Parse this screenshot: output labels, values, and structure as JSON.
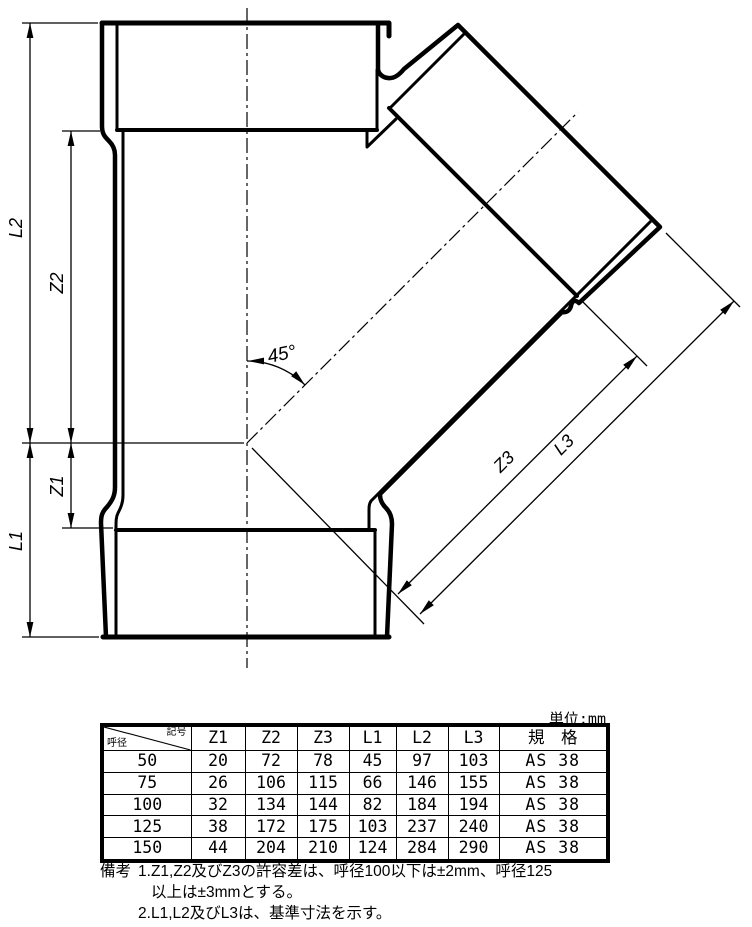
{
  "drawing": {
    "labels": {
      "L2": "L2",
      "Z2": "Z2",
      "Z1": "Z1",
      "L1": "L1",
      "Z3": "Z3",
      "L3": "L3",
      "angle": "45°"
    }
  },
  "table": {
    "unit_label": "単位:mm",
    "corner_top_right": "記号",
    "corner_bottom_left": "呼径",
    "headers": [
      "Z1",
      "Z2",
      "Z3",
      "L1",
      "L2",
      "L3"
    ],
    "standard_header": "規　格",
    "rows": [
      {
        "dia": "50",
        "z1": "20",
        "z2": "72",
        "z3": "78",
        "l1": "45",
        "l2": "97",
        "l3": "103",
        "std": "AS 38"
      },
      {
        "dia": "75",
        "z1": "26",
        "z2": "106",
        "z3": "115",
        "l1": "66",
        "l2": "146",
        "l3": "155",
        "std": "AS 38"
      },
      {
        "dia": "100",
        "z1": "32",
        "z2": "134",
        "z3": "144",
        "l1": "82",
        "l2": "184",
        "l3": "194",
        "std": "AS 38"
      },
      {
        "dia": "125",
        "z1": "38",
        "z2": "172",
        "z3": "175",
        "l1": "103",
        "l2": "237",
        "l3": "240",
        "std": "AS 38"
      },
      {
        "dia": "150",
        "z1": "44",
        "z2": "204",
        "z3": "210",
        "l1": "124",
        "l2": "284",
        "l3": "290",
        "std": "AS 38"
      }
    ]
  },
  "notes": {
    "label": "備考",
    "item1_no": "1.",
    "item1_line1": "Z1,Z2及びZ3の許容差は、呼径100以下は±2mm、呼径125",
    "item1_line2": "以上は±3mmとする。",
    "item2_no": "2.",
    "item2_line1": "L1,L2及びL3は、基準寸法を示す。"
  }
}
